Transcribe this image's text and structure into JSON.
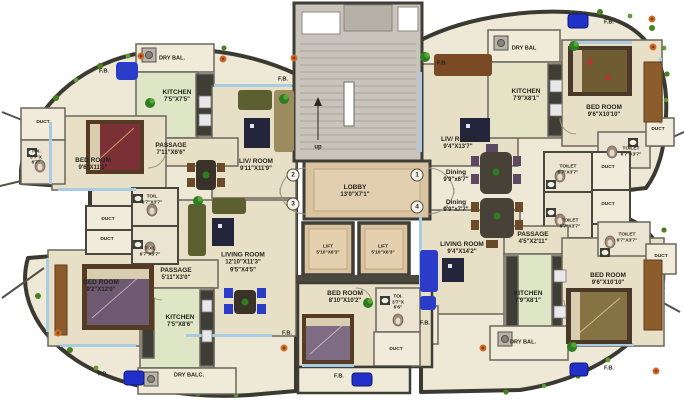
{
  "common": {
    "fb": "F.B.",
    "duct": "DUCT"
  },
  "center": {
    "up": "up",
    "lobby": {
      "name": "LOBBY",
      "dims": "13'0\"X7'1\""
    },
    "lift": {
      "name": "LIFT",
      "dims": "5'10\"X6'3\""
    },
    "units": {
      "u1": "1",
      "u2": "2",
      "u3": "3",
      "u4": "4"
    }
  },
  "cluster_left": {
    "toilet": {
      "name": "TOIL",
      "dims": "6'7\"X3'7\""
    }
  },
  "cluster_right": {
    "toilet": {
      "name": "TOILET",
      "dims": "6'7\"X3'7\""
    }
  },
  "unit1": {
    "living": {
      "name": "LIV/ ROOM",
      "dims": "9'4\"X13'7\""
    },
    "dining": {
      "name": "Dining",
      "dims": "9'9\"x6'7\""
    },
    "kitchen": {
      "name": "KITCHEN",
      "dims": "7'9\"X8'1\""
    },
    "bedroom": {
      "name": "BED ROOM",
      "dims": "9'6\"X10'10\""
    },
    "drybal": "DRY BAL",
    "toilet": {
      "name": "TOILET",
      "dims": "6'7\"X3'7\""
    }
  },
  "unit2": {
    "living": {
      "name": "LIV/ ROOM",
      "dims": "9'11\"X11'9\""
    },
    "kitchen": {
      "name": "KITCHEN",
      "dims": "7'5\"X7'5\""
    },
    "passage": {
      "name": "PASSAGE",
      "dims": "7'11\"X6'6\""
    },
    "bedroom": {
      "name": "BED ROOM",
      "dims": "9'6\"X11'5\""
    },
    "drybal": "DRY BAL.",
    "toilet": {
      "name": "TOI.",
      "dims": "3'7\"X",
      "dims2": "6'7\""
    }
  },
  "unit3": {
    "living": {
      "name": "LIVING ROOM",
      "dims": "12'10\"X11'3\"",
      "dims2": "9'5\"X4'5\""
    },
    "passage": {
      "name": "PASSAGE",
      "dims": "5'11\"X3'0\""
    },
    "bedroom": {
      "name": "BED ROOM",
      "dims": "9'2\"X12'0\""
    },
    "bedroom2": {
      "name": "BED ROOM",
      "dims": "8'10\"X10'2\""
    },
    "kitchen": {
      "name": "KITCHEN",
      "dims": "7'5\"X8'6\""
    },
    "drybal": "DRY BALC.",
    "toilet2": {
      "name": "TOI.",
      "dims": "3'7\"X",
      "dims2": "6'6\""
    }
  },
  "unit4": {
    "living": {
      "name": "LIVING ROOM",
      "dims": "9'4\"X14'2\""
    },
    "dining": {
      "name": "Dining",
      "dims": "9'9\"x7'7\""
    },
    "passage": {
      "name": "PASSAGE",
      "dims": "4'5\"X2'11\""
    },
    "kitchen": {
      "name": "KITCHEN",
      "dims": "7'9\"X8'1\""
    },
    "bedroom": {
      "name": "BED ROOM",
      "dims": "9'6\"X10'10\""
    },
    "drybal": "DRY BAL.",
    "toilet": {
      "name": "TOILET",
      "dims": "6'7\"X3'7\""
    }
  },
  "colors": {
    "wall": "#3b3a32",
    "floor": "#e7dfc6",
    "balcony": "#f0ead9",
    "kitchen_floor": "#dfe6c6",
    "lobby": "#d9c3a1",
    "window": "#a9cce2",
    "sofa_blue": "#2a3cc8",
    "plant": "#2f7d22"
  }
}
